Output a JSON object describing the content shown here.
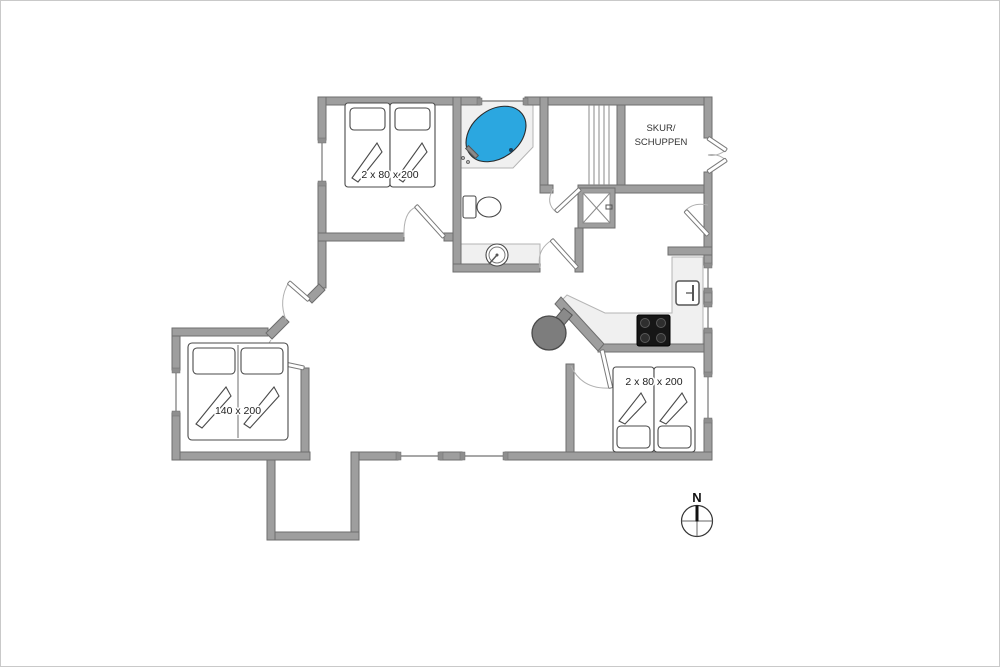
{
  "plan": {
    "labels": {
      "bedroom_top_bed": "2 x 80 x 200",
      "bedroom_left_bed": "140 x 200",
      "bedroom_right_bed": "2 x 80 x 200",
      "shed_line1": "SKUR/",
      "shed_line2": "SCHUPPEN",
      "compass_north": "N"
    },
    "colors": {
      "wall": "#9e9e9e",
      "wall_outline": "#6e6e6e",
      "fixture_fill": "#f0f0f0",
      "tub_fill": "#2ba7e0",
      "stove_fill": "#7d7d7d",
      "cooktop_fill": "#161616",
      "label_text": "#333333"
    },
    "fixtures": [
      "double-twin-bed-top",
      "double-bed-left",
      "double-twin-bed-right",
      "corner-bathtub",
      "toilet",
      "round-sink",
      "shower-cabin",
      "sauna-slats",
      "fridge",
      "cooktop",
      "wood-stove",
      "compass-rose"
    ]
  }
}
